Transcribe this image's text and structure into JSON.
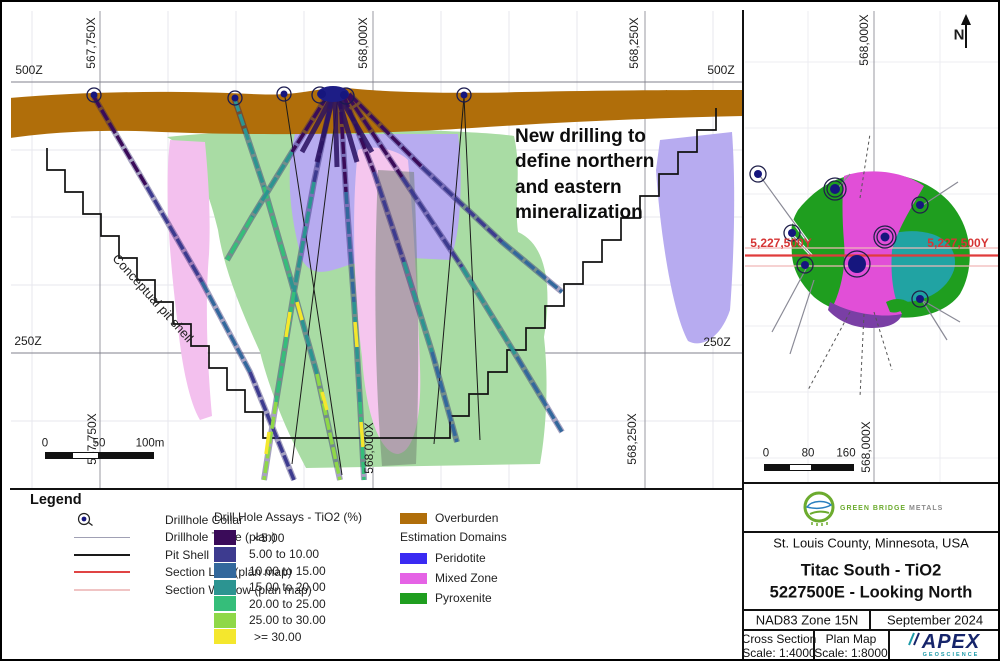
{
  "cross_section": {
    "top_labels": [
      "567,750X",
      "568,000X",
      "568,250X"
    ],
    "bottom_labels": [
      "567,750X",
      "568,000X",
      "568,250X"
    ],
    "label_500z": "500Z",
    "label_250z": "250Z",
    "annotation_lines": [
      "New drilling to",
      "define northern",
      "and eastern",
      "mineralization"
    ],
    "pit_shell_label": "Conceptual pit shell",
    "scale_bar": {
      "zero": "0",
      "fifty": "50",
      "hundred": "100m"
    }
  },
  "plan_map": {
    "axis_label": "568,000X",
    "y_label": "5,227,500Y",
    "north_label": "N",
    "scale_bar": {
      "zero": "0",
      "mid": "80",
      "end": "160"
    }
  },
  "legend": {
    "title": "Legend",
    "collar_label": "Drillhole Collar",
    "trace_label": "Drillhole Trace (plan)",
    "trace_color": "#a0a0b4",
    "pit_label": "Pit Shell",
    "pit_color": "#1a1a1a",
    "section_line_label": "Section Line (plan map)",
    "section_line_color": "#e04444",
    "section_window_label": "Section Window (plan map)",
    "section_window_color": "#f0c4c4",
    "assay_title": "Drill Hole Assays - TiO2 (%)",
    "assay_items": [
      {
        "label": "<5.00",
        "color": "#3a0b59"
      },
      {
        "label": "5.00 to 10.00",
        "color": "#3d3b8f"
      },
      {
        "label": "10.00 to 15.00",
        "color": "#33689c"
      },
      {
        "label": "15.00 to 20.00",
        "color": "#2c9491"
      },
      {
        "label": "20.00 to 25.00",
        "color": "#35be7a"
      },
      {
        "label": "25.00 to 30.00",
        "color": "#8fd848"
      },
      {
        "label": ">= 30.00",
        "color": "#f4e72d"
      }
    ],
    "overburden_label": "Overburden",
    "overburden_color": "#b06e0a",
    "domains_title": "Estimation Domains",
    "domain_items": [
      {
        "label": "Peridotite",
        "color": "#3a2af2"
      },
      {
        "label": "Mixed Zone",
        "color": "#e563e5"
      },
      {
        "label": "Pyroxenite",
        "color": "#1f9e1f"
      }
    ]
  },
  "title_block": {
    "company_first": "GREEN BRIDGE",
    "company_last": " METALS",
    "location": "St. Louis County, Minnesota, USA",
    "title_line1": "Titac South - TiO2",
    "title_line2": "5227500E - Looking North",
    "datum": "NAD83 Zone 15N",
    "date": "September 2024",
    "cs_scale_label": "Cross Section",
    "cs_scale": "Scale: 1:4000",
    "pm_scale_label": "Plan Map",
    "pm_scale": "Scale: 1:8000",
    "apex_name": "APEX",
    "apex_sub": "GEOSCIENCE"
  }
}
